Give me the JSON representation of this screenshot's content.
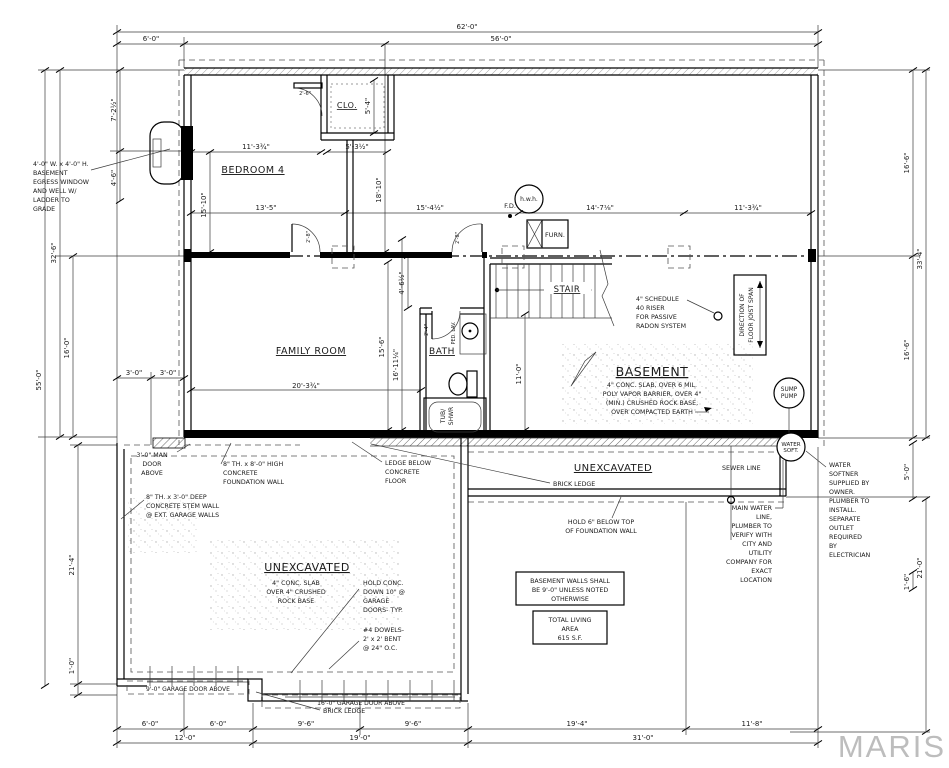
{
  "watermark": "MARIS",
  "rooms": {
    "bedroom": "BEDROOM 4",
    "closet": "CLO.",
    "family": "FAMILY ROOM",
    "bath": "BATH",
    "stair": "STAIR",
    "basement": "BASEMENT",
    "unexcavated_strip": "UNEXCAVATED",
    "unexcavated_garage": "UNEXCAVATED"
  },
  "equipment": {
    "furnace": "FURN.",
    "water_heater": "h.w.h.",
    "floor_drain": "F.D.",
    "sump": [
      "SUMP",
      "PUMP"
    ],
    "softener": [
      "WATER",
      "SOFT."
    ],
    "tub": [
      "TUB/",
      "SHWR"
    ],
    "lav": "PED. LAV."
  },
  "dims": {
    "overall": "62'-0\"",
    "offset6": "6'-0\"",
    "main56": "56'-0\"",
    "bed_top": "11'-3¾\"",
    "clo_w": "5'-3½\"",
    "clo_d": "5'-4\"",
    "bed_h": "15'-10\"",
    "row_13_5": "13'-5\"",
    "row_15_4": "15'-4½\"",
    "row_14_7": "14'-7⅛\"",
    "row_11_3": "11'-3¾\"",
    "l_7_2": "7'-2½\"",
    "l_4_6": "4'-6\"",
    "l_32_6": "32'-6\"",
    "l_16_0": "16'-0\"",
    "l_55_0": "55'-0\"",
    "l_3_0a": "3'-0\"",
    "l_3_0b": "3'-0\"",
    "l_21_4": "21'-4\"",
    "l_1_0": "1'-0\"",
    "v_18_10": "18'-10\"",
    "v_4_6": "4'-6½\"",
    "v_15_6": "15'-6\"",
    "v_16_11": "16'-11¼\"",
    "v_11_0": "11'-0\"",
    "fam_w": "20'-3¾\"",
    "r_16_6a": "16'-6\"",
    "r_33_4": "33'-4\"",
    "r_16_6b": "16'-6\"",
    "r_5_0": "5'-0\"",
    "r_1_6": "1'-6\"",
    "r_21_0": "21'-0\"",
    "b_6a": "6'-0\"",
    "b_6b": "6'-0\"",
    "b_9a": "9'-6\"",
    "b_9b": "9'-6\"",
    "b_19_4": "19'-4\"",
    "b_11_8": "11'-8\"",
    "b_12": "12'-0\"",
    "b_19": "19'-0\"",
    "b_31": "31'-0\"",
    "door_2_6": "2'-6\"",
    "door_2_8a": "2'-8\"",
    "door_2_8b": "2'-8\"",
    "door_2_4": "2'-4\""
  },
  "notes": {
    "egress": [
      "4'-0\" W. x 4'-0\" H.",
      "BASEMENT",
      "EGRESS WINDOW",
      "AND WELL W/",
      "LADDER TO",
      "GRADE"
    ],
    "radon": [
      "4\" SCHEDULE",
      "40 RISER",
      "FOR PASSIVE",
      "RADON SYSTEM"
    ],
    "joist": [
      "DIRECTION OF",
      "FLOOR JOIST SPAN"
    ],
    "bsmt_slab": [
      "4\" CONC. SLAB, OVER 6 MIL.",
      "POLY VAPOR BARRIER, OVER 4\"",
      "(MIN.) CRUSHED ROCK BASE,",
      "OVER COMPACTED EARTH"
    ],
    "man_door": [
      "3'-0\" MAN",
      "DOOR",
      "ABOVE"
    ],
    "fnd_wall": [
      "8\" TH. x 8'-0\" HIGH",
      "CONCRETE",
      "FOUNDATION WALL"
    ],
    "stem_wall": [
      "8\" TH. x 3'-0\" DEEP",
      "CONCRETE STEM WALL",
      "@ EXT. GARAGE WALLS"
    ],
    "ledge": [
      "LEDGE BELOW",
      "CONCRETE",
      "FLOOR"
    ],
    "gar_slab": [
      "4\" CONC. SLAB",
      "OVER 4\" CRUSHED",
      "ROCK BASE"
    ],
    "hold_conc": [
      "HOLD CONC.",
      "DOWN 10\" @",
      "GARAGE",
      "DOORS- TYP."
    ],
    "dowels": [
      "#4 DOWELS-",
      "2' x 2' BENT",
      "@ 24\" O.C."
    ],
    "brick_ledge_a": "BRICK LEDGE",
    "brick_ledge_b": "BRICK LEDGE",
    "hold6": [
      "HOLD 6\" BELOW TOP",
      "OF FOUNDATION WALL"
    ],
    "bsmt_walls": [
      "BASEMENT WALLS SHALL",
      "BE 9'-0\" UNLESS NOTED",
      "OTHERWISE"
    ],
    "living": [
      "TOTAL LIVING",
      "AREA",
      "615 S.F."
    ],
    "softener": [
      "WATER",
      "SOFTNER",
      "SUPPLIED BY",
      "OWNER.",
      "PLUMBER TO",
      "INSTALL.",
      "SEPARATE",
      "OUTLET",
      "REQUIRED",
      "BY",
      "ELECTRICIAN"
    ],
    "sewer": "SEWER LINE",
    "main_water": [
      "MAIN WATER",
      "LINE,",
      "PLUMBER TO",
      "VERIFY WITH",
      "CITY AND",
      "UTILITY",
      "COMPANY FOR",
      "EXACT",
      "LOCATION"
    ],
    "gd9": "9'-0\" GARAGE DOOR ABOVE",
    "gd16": "16'-0\" GARAGE DOOR ABOVE"
  }
}
